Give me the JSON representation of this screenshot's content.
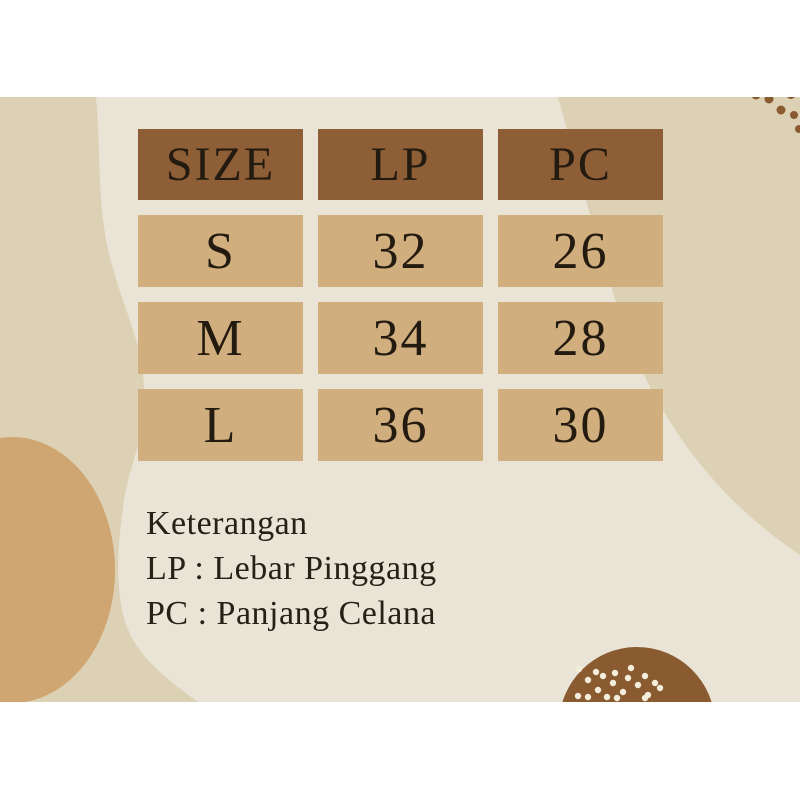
{
  "size_chart": {
    "headers": [
      "SIZE",
      "LP",
      "PC"
    ],
    "rows": [
      {
        "size": "S",
        "lp": "32",
        "pc": "26"
      },
      {
        "size": "M",
        "lp": "34",
        "pc": "28"
      },
      {
        "size": "L",
        "lp": "36",
        "pc": "30"
      }
    ]
  },
  "legend": {
    "title": "Keterangan",
    "items": [
      "LP : Lebar Pinggang",
      "PC : Panjang Celana"
    ]
  },
  "colors": {
    "letterbox": "#ffffff",
    "canvas_cream": "#eae4d6",
    "beige_shape": "#ddd1b5",
    "tan_blob": "#cfa671",
    "header_brown": "#8e5f37",
    "cell_tan": "#d0ae7e",
    "circle_brown": "#8a5a30",
    "dot_cream": "#f3eddc",
    "text_dark": "#241b10"
  }
}
